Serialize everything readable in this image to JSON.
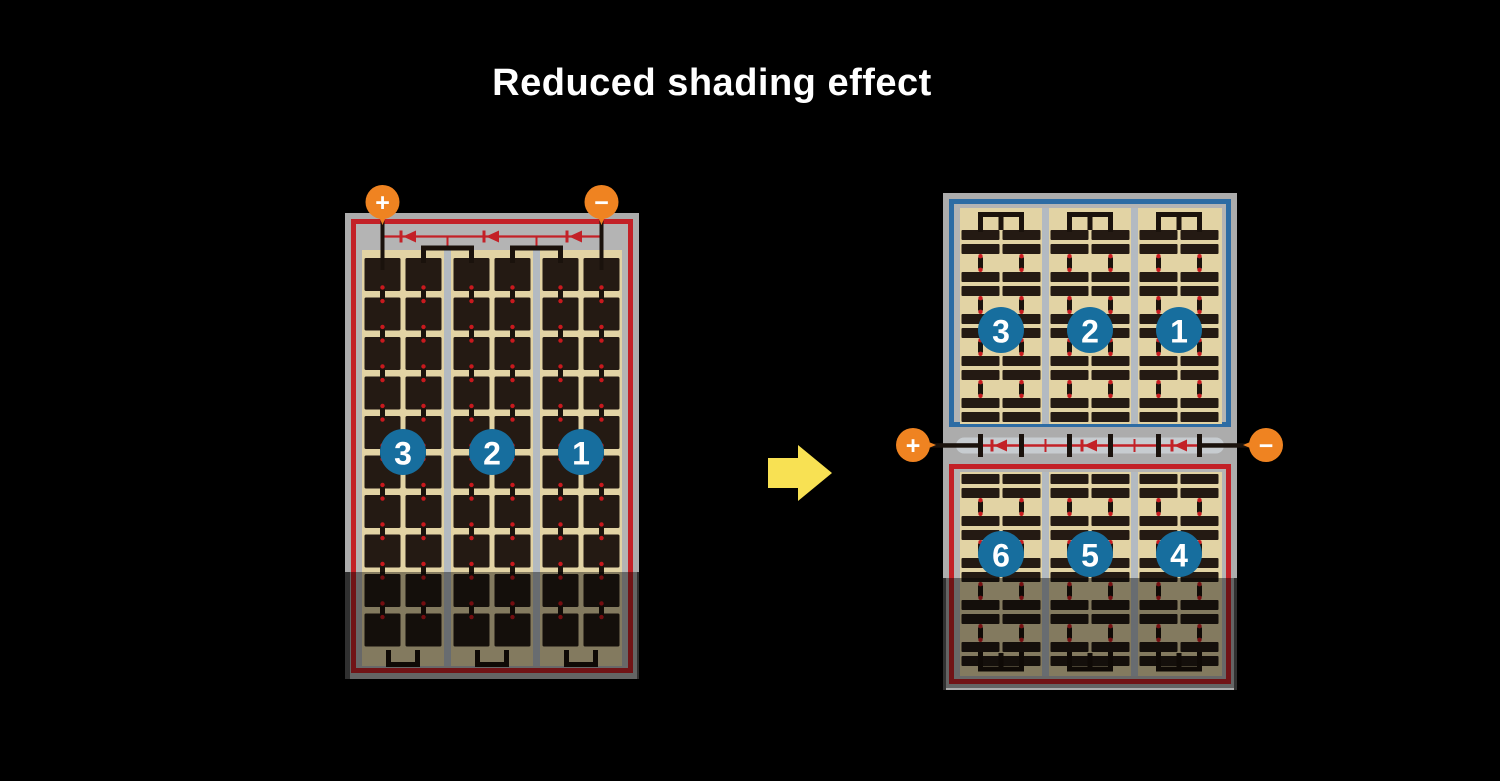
{
  "title": "Reduced shading effect",
  "colors": {
    "background": "#000000",
    "frame": "#ACACAC",
    "inner_gray": "#B4B4B4",
    "tan": "#E2D3A4",
    "cell": "#241A13",
    "divider": "#B3BAC1",
    "red": "#C32127",
    "blue": "#2D6CA4",
    "badge": "#176E9E",
    "orange": "#EF8321",
    "yellow": "#F8E153",
    "dot": "#C8191E",
    "wire": "#1A120C",
    "capsule": "#C7CCD0",
    "label_white": "#FFFFFF"
  },
  "left_panel": {
    "terminals": {
      "positive": "+",
      "negative": "−"
    },
    "string_badges": [
      "3",
      "2",
      "1"
    ]
  },
  "right_panel": {
    "terminals": {
      "positive": "+",
      "negative": "−"
    },
    "top_module_badges": [
      "3",
      "2",
      "1"
    ],
    "bottom_module_badges": [
      "6",
      "5",
      "4"
    ]
  }
}
